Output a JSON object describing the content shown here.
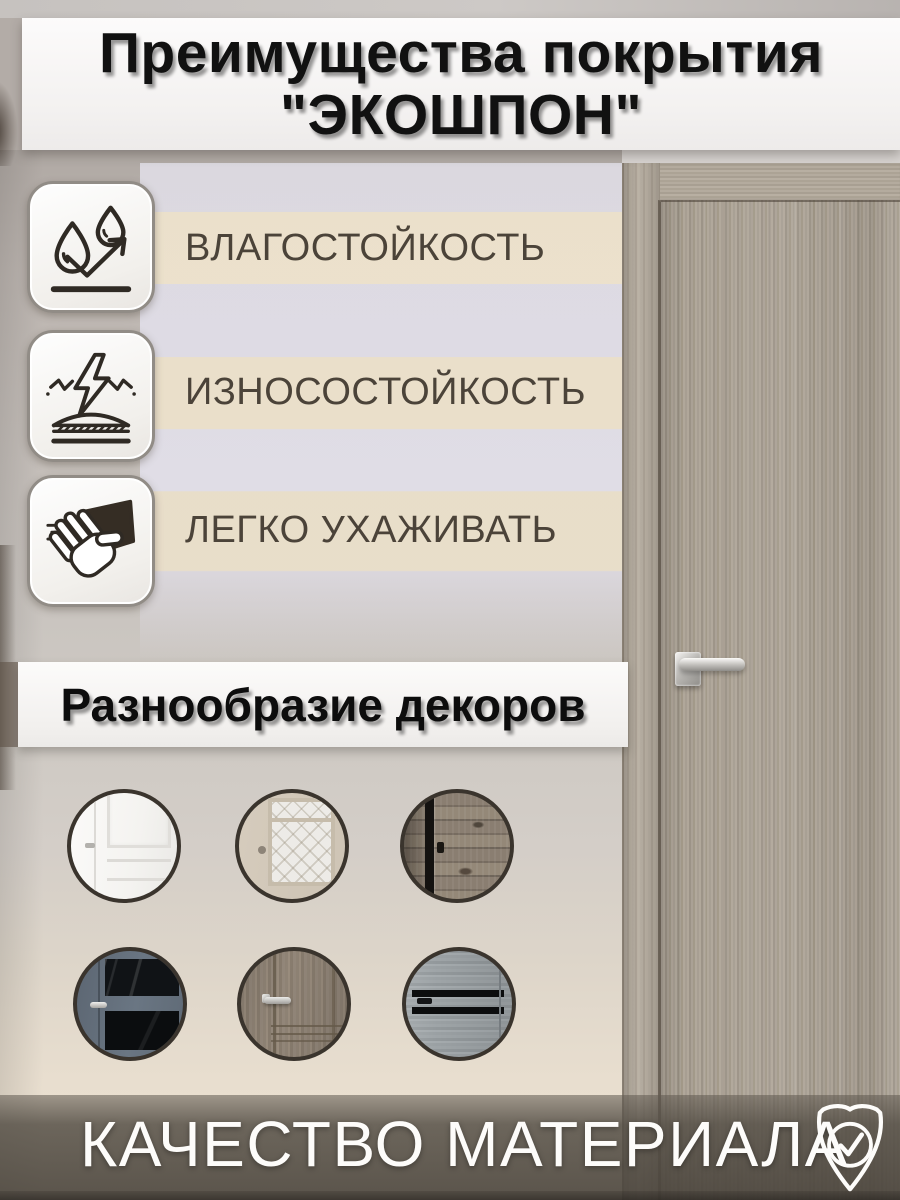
{
  "header": {
    "title_line1": "Преимущества покрытия",
    "title_line2": "\"ЭКОШПОН\""
  },
  "features": [
    {
      "label": "ВЛАГОСТОЙКОСТЬ",
      "icon": "water-drops-bounce-icon"
    },
    {
      "label": "ИЗНОСОСТОЙКОСТЬ",
      "icon": "impact-protection-icon"
    },
    {
      "label": "ЛЕГКО УХАЖИВАТЬ",
      "icon": "hand-wiping-cloth-icon"
    }
  ],
  "decors": {
    "title": "Разнообразие декоров",
    "items": [
      {
        "name": "white-classic-panel-door"
      },
      {
        "name": "ivory-door-patterned-glass"
      },
      {
        "name": "dark-rustic-wood-door"
      },
      {
        "name": "slate-blue-door-black-glass"
      },
      {
        "name": "brown-wood-classic-door"
      },
      {
        "name": "grey-wood-door-black-stripes"
      }
    ]
  },
  "quality": {
    "label": "КАЧЕСТВО МАТЕРИАЛА",
    "icon": "shield-check-icon"
  },
  "colors": {
    "band_beige": "#ece1cd",
    "band_light": "#e2e0e8",
    "label_text": "#4b4339",
    "banner_taupe": "#6e675e",
    "door_wood": "#a59c90"
  }
}
